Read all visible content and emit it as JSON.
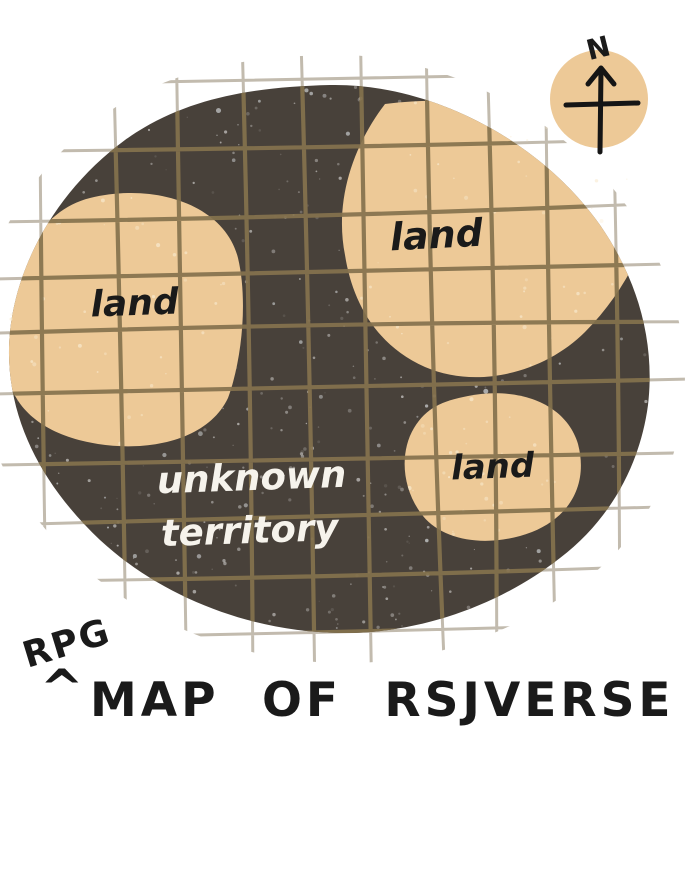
{
  "map": {
    "region_labels": [
      {
        "id": "west",
        "text": "land"
      },
      {
        "id": "northeast",
        "text": "land"
      },
      {
        "id": "southeast",
        "text": "land"
      }
    ],
    "territory_label": {
      "line1": "unknown",
      "line2": "territory"
    },
    "compass": {
      "north": "N"
    },
    "colors": {
      "background": "#ffffff",
      "territory": "#48413a",
      "land": "#edc997",
      "grid_on_map": "#85724e",
      "grid_outside": "#b8afa0",
      "ink": "#1a1a1a",
      "label_white": "#f6f3ec"
    }
  },
  "title": {
    "annotation": "RPG",
    "caret": "^",
    "text": "MAP OF RSJVERSE"
  }
}
